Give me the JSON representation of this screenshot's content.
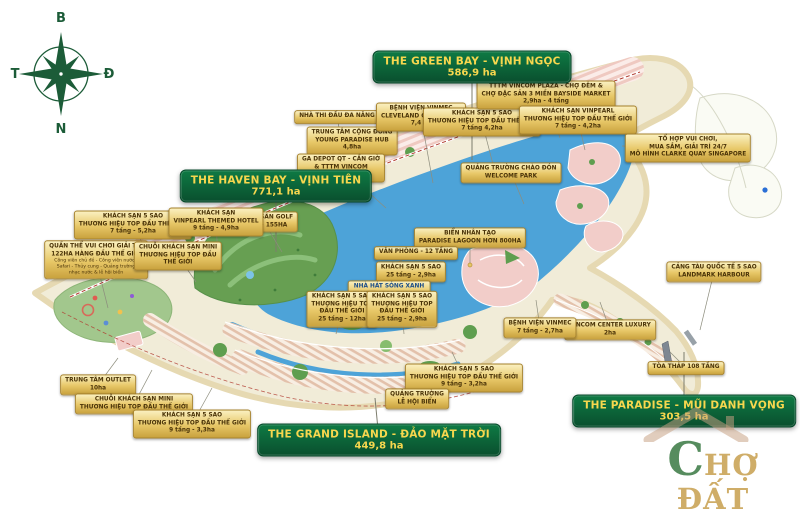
{
  "palette": {
    "zone_box_top": "#0e7a44",
    "zone_box_bottom": "#0a4f2e",
    "zone_text": "#f7d74e",
    "label_top": "#faf0c0",
    "label_mid": "#e7c767",
    "label_bottom": "#c9a23e",
    "label_border": "#a8842f",
    "label_text": "#4a3308",
    "label_text_blue": "#1d4e89",
    "leader": "#8d8d7d",
    "water": "#4da3d8",
    "land": "#f1ecd8",
    "sand": "#e6d9b2",
    "park": "#5f9e4f",
    "block_pink": "#f2cdc9",
    "road_red": "#b03a2e",
    "compass": "#1c5c38",
    "wm_green": "#3f7d48",
    "wm_gold": "#c9a254"
  },
  "compass": {
    "north": "B",
    "east": "Đ",
    "south": "N",
    "west": "T"
  },
  "zones": [
    {
      "id": "green-bay",
      "name": "THE GREEN BAY - VỊNH NGỌC",
      "area": "586,9 ha",
      "x": 472,
      "y": 67,
      "leader": [
        472,
        160
      ]
    },
    {
      "id": "haven-bay",
      "name": "THE HAVEN BAY - VỊNH TIÊN",
      "area": "771,1 ha",
      "x": 276,
      "y": 186,
      "leader": [
        276,
        252
      ]
    },
    {
      "id": "grand-island",
      "name": "THE GRAND ISLAND - ĐẢO MẶT TRỜI",
      "area": "449,8 ha",
      "x": 379,
      "y": 440,
      "leader": [
        375,
        398
      ]
    },
    {
      "id": "paradise",
      "name": "THE PARADISE - MŨI DANH VỌNG",
      "area": "303,5 ha",
      "x": 684,
      "y": 411,
      "leader": [
        684,
        352
      ]
    }
  ],
  "labels": [
    {
      "id": "nha-thi-dau-da-nang",
      "x": 337,
      "y": 117,
      "lines": [
        "NHÀ THI ĐẤU ĐA NĂNG"
      ],
      "leader": [
        352,
        196
      ]
    },
    {
      "id": "young-paradise-hub",
      "x": 352,
      "y": 141,
      "lines": [
        "TRUNG TÂM CỘNG ĐỒNG",
        "YOUNG PARADISE HUB",
        "4,8ha"
      ],
      "leader": [
        368,
        200
      ]
    },
    {
      "id": "benh-vien-vinmec-cleveland",
      "x": 421,
      "y": 117,
      "lines": [
        "BỆNH VIỆN VINMEC",
        "CLEVELAND CONNECTED",
        "7,4 ha"
      ],
      "leader": [
        433,
        183
      ]
    },
    {
      "id": "ga-depot-vincom-mega-mall",
      "x": 341,
      "y": 168,
      "lines": [
        "GA DEPOT QT - CẦN GIỜ",
        "& TTTM VINCOM",
        "MEGA MALL"
      ],
      "leader": [
        386,
        208
      ]
    },
    {
      "id": "quang-truong-chao-don",
      "x": 511,
      "y": 173,
      "lines": [
        "QUẢNG TRƯỜNG CHÀO ĐÓN",
        "WELCOME PARK"
      ],
      "leader": [
        524,
        204
      ]
    },
    {
      "id": "khach-san-5-sao-4-2ha",
      "x": 482,
      "y": 122,
      "lines": [
        "KHÁCH SẠN 5 SAO",
        "THƯƠNG HIỆU TOP ĐẦU THẾ GIỚI",
        "7 tầng 4,2ha"
      ],
      "leader": [
        495,
        172
      ]
    },
    {
      "id": "tttm-vincom-plaza",
      "x": 546,
      "y": 95,
      "lines": [
        "TTTM VINCOM PLAZA - CHỢ ĐÊM &",
        "CHỢ ĐẶC SẢN 3 MIỀN BAYSIDE MARKET",
        "2,9ha - 4 tầng"
      ],
      "leader": [
        560,
        138
      ]
    },
    {
      "id": "khach-san-vinpearl",
      "x": 578,
      "y": 120,
      "lines": [
        "KHÁCH SẠN VINPEARL",
        "THƯƠNG HIỆU TOP ĐẦU THẾ GIỚI",
        "7 tầng - 4,2ha"
      ],
      "leader": [
        585,
        150
      ]
    },
    {
      "id": "to-hop-clarke-quay",
      "x": 688,
      "y": 148,
      "lines": [
        "TỔ HỢP VUI CHƠI,",
        "MUA SẮM, GIẢI TRÍ 24/7",
        "MÔ HÌNH CLARKE QUAY SINGAPORE"
      ],
      "leader": [
        622,
        146
      ]
    },
    {
      "id": "cang-tau-quoc-te",
      "x": 714,
      "y": 272,
      "lines": [
        "CẢNG TÀU QUỐC TẾ 5 SAO",
        "LANDMARK HARBOUR"
      ],
      "leader": [
        700,
        330
      ]
    },
    {
      "id": "toa-thap-108-tang",
      "x": 686,
      "y": 368,
      "lines": [
        "TÒA THÁP 108 TẦNG"
      ],
      "leader": [
        670,
        352
      ]
    },
    {
      "id": "vincom-center-luxury",
      "x": 610,
      "y": 330,
      "lines": [
        "VINCOM CENTER LUXURY",
        "2ha"
      ],
      "leader": [
        600,
        302
      ]
    },
    {
      "id": "benh-vien-vinmec",
      "x": 540,
      "y": 328,
      "lines": [
        "BỆNH VIỆN VINMEC",
        "7 tầng - 2,7ha"
      ],
      "leader": [
        536,
        300
      ]
    },
    {
      "id": "bien-nhan-tao-paradise-lagoon",
      "x": 470,
      "y": 238,
      "lines": [
        "BIỂN NHÂN TẠO",
        "PARADISE LAGOON HƠN 800HA"
      ],
      "leader": [
        470,
        265
      ],
      "dot": true
    },
    {
      "id": "van-phong-12-tang",
      "x": 416,
      "y": 253,
      "lines": [
        "VĂN PHÒNG - 12 TẦNG"
      ],
      "leader": [
        398,
        262
      ]
    },
    {
      "id": "khach-san-25-tang-2-9ha",
      "x": 411,
      "y": 272,
      "lines": [
        "KHÁCH SẠN 5 SAO",
        "25 tầng - 2,9ha"
      ],
      "leader": [
        393,
        280
      ]
    },
    {
      "id": "nha-hat-song-xanh",
      "x": 389,
      "y": 291,
      "lines": [
        "NHÀ HÁT SÓNG XANH",
        "BLUE WAVES THEATRE"
      ],
      "accent": "blue",
      "leader": [
        368,
        300
      ]
    },
    {
      "id": "khach-san-25-tang-12ha",
      "x": 342,
      "y": 309,
      "lines": [
        "KHÁCH SẠN 5 SAO",
        "THƯƠNG HIỆU TOP",
        "ĐẦU THẾ GIỚI",
        "25 tầng - 12ha"
      ],
      "leader": [
        336,
        334
      ]
    },
    {
      "id": "khach-san-25-tang-2-9ha-b",
      "x": 402,
      "y": 309,
      "lines": [
        "KHÁCH SẠN 5 SAO",
        "THƯƠNG HIỆU TOP",
        "ĐẦU THẾ GIỚI",
        "25 tầng - 2,9ha"
      ],
      "leader": [
        404,
        334
      ]
    },
    {
      "id": "bo-doi-san-golf",
      "x": 264,
      "y": 222,
      "lines": [
        "BỘ ĐÔI SÂN GOLF",
        "18 LỖ - 155HA"
      ],
      "leader": [
        282,
        252
      ]
    },
    {
      "id": "khach-san-5-sao-5-2ha",
      "x": 133,
      "y": 225,
      "lines": [
        "KHÁCH SẠN 5 SAO",
        "THƯƠNG HIỆU TOP ĐẦU THẾ GIỚI",
        "7 tầng - 5,2ha"
      ],
      "leader": [
        152,
        262
      ]
    },
    {
      "id": "khach-san-vinpearl-themed",
      "x": 216,
      "y": 222,
      "lines": [
        "KHÁCH SẠN",
        "VINPEARL THEMED HOTEL",
        "9 tầng - 4,9ha"
      ],
      "leader": [
        218,
        258
      ]
    },
    {
      "id": "quan-the-vui-choi",
      "x": 96,
      "y": 260,
      "lines": [
        "QUẦN THỂ VUI CHƠI GIẢI TRÍ",
        "122HA HÀNG ĐẦU THẾ GIỚI"
      ],
      "small": [
        "Công viên chủ đề - Công viên nước -",
        "Safari - Thủy cung - Quảng trường",
        "nhạc nước & lễ hội biển"
      ],
      "leader": [
        108,
        308
      ]
    },
    {
      "id": "chuoi-khach-san-mini-1",
      "x": 178,
      "y": 256,
      "lines": [
        "CHUỖI KHÁCH SẠN MINI",
        "THƯƠNG HIỆU TOP ĐẦU",
        "THẾ GIỚI"
      ],
      "leader": [
        196,
        282
      ]
    },
    {
      "id": "trung-tam-outlet",
      "x": 98,
      "y": 385,
      "lines": [
        "TRUNG TÂM OUTLET",
        "10ha"
      ],
      "leader": [
        118,
        358
      ]
    },
    {
      "id": "chuoi-khach-san-mini-2",
      "x": 134,
      "y": 404,
      "lines": [
        "CHUỖI KHÁCH SẠN MINI",
        "THƯƠNG HIỆU TOP ĐẦU THẾ GIỚI"
      ],
      "leader": [
        152,
        370
      ]
    },
    {
      "id": "khach-san-5-sao-3-3ha",
      "x": 192,
      "y": 424,
      "lines": [
        "KHÁCH SẠN 5 SAO",
        "THƯƠNG HIỆU TOP ĐẦU THẾ GIỚI",
        "9 tầng - 3,3ha"
      ],
      "leader": [
        212,
        388
      ]
    },
    {
      "id": "khach-san-5-sao-3-2ha",
      "x": 464,
      "y": 378,
      "lines": [
        "KHÁCH SẠN 5 SAO",
        "THƯƠNG HIỆU TOP ĐẦU THẾ GIỚI",
        "9 tầng - 3,2ha"
      ],
      "leader": [
        452,
        352
      ]
    },
    {
      "id": "quang-truong-le-hoi-bien",
      "x": 417,
      "y": 399,
      "lines": [
        "QUẢNG TRƯỜNG",
        "LỄ HỘI BIỂN"
      ],
      "leader": [
        420,
        376
      ]
    }
  ],
  "watermark": {
    "prefix": "C",
    "rest": "HỢ ĐẤT"
  }
}
